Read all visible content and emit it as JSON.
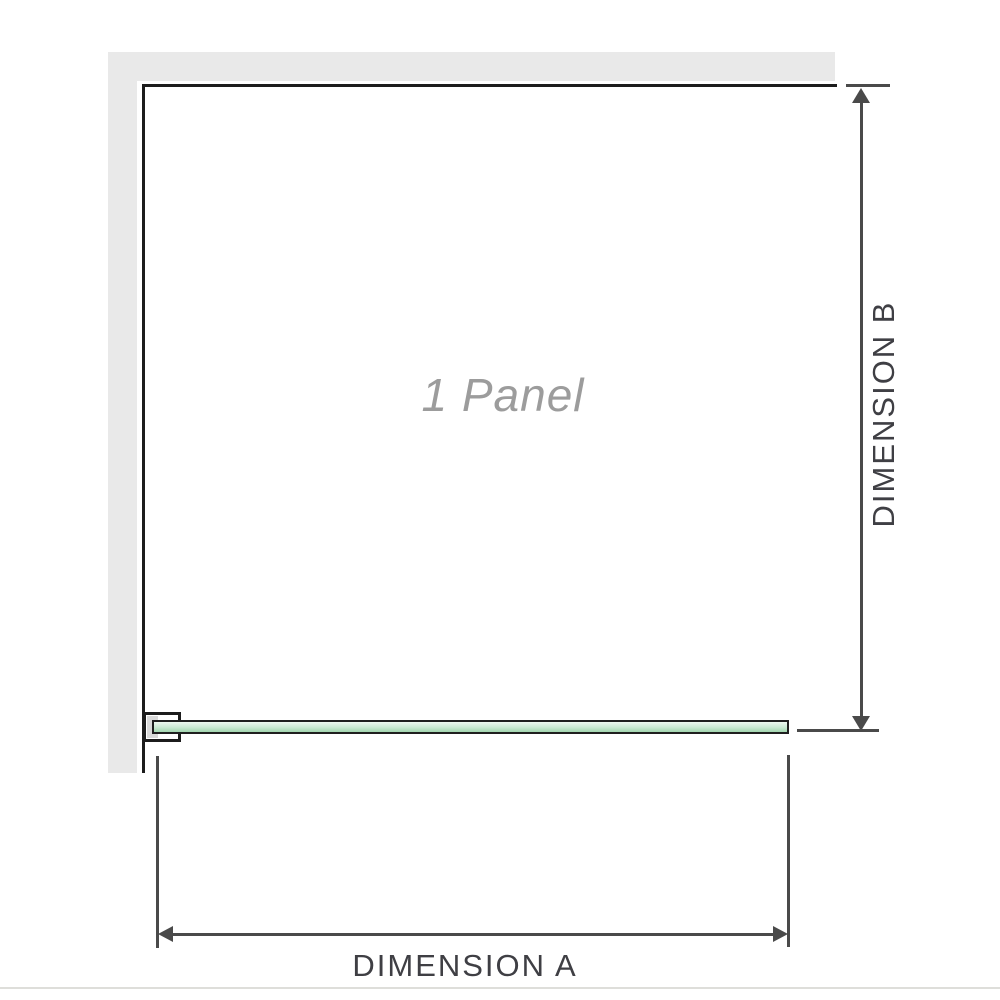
{
  "diagram": {
    "panel_label": "1 Panel",
    "dimension_a_label": "DIMENSION A",
    "dimension_b_label": "DIMENSION B"
  },
  "colors": {
    "background": "#ffffff",
    "wall": "#e9e9e9",
    "outline": "#1c1c1c",
    "dimension": "#4a4a4a",
    "dim_text": "#3f3f44",
    "panel_text": "#9c9c9c",
    "bracket_pad": "#d9d9d9",
    "glass_border": "#1f1f1f",
    "glass_top": "#eef8f1",
    "glass_mid": "#c9e9d2",
    "glass_bottom": "#a2d6af",
    "bottom_rule": "#dededa"
  }
}
